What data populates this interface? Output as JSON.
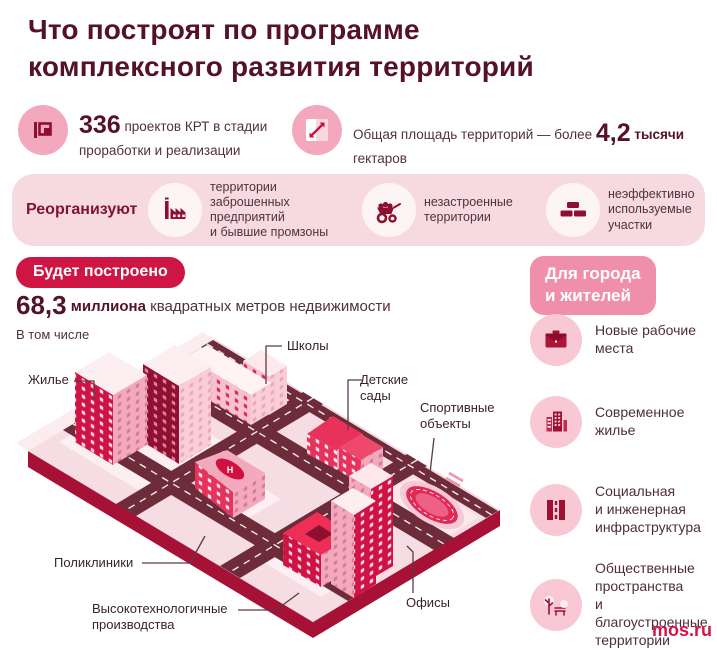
{
  "colors": {
    "dark_burgundy": "#551226",
    "accent_red": "#ce1543",
    "pink_badge": "#ef8fab",
    "band_bg": "#f7d9e1",
    "icon_dark": "#8e1030",
    "mosru_red": "#d31445"
  },
  "header": {
    "line1": "Что построят по программе",
    "line2": "комплексного развития территорий"
  },
  "stats": [
    {
      "icon": "area-plan-icon",
      "value": "336",
      "text": "проектов КРТ в стадии проработки и реализации"
    },
    {
      "icon": "expand-arrow-icon",
      "prefix": "Общая площадь территорий — более",
      "value": "4,2",
      "bold": "тысячи",
      "suffix": "гектаров"
    }
  ],
  "reorganize": {
    "label": "Реорганизуют",
    "items": [
      {
        "icon": "factory-icon",
        "text": "территории\nзаброшенных\nпредприятий\nи бывшие промзоны"
      },
      {
        "icon": "wheelbarrow-icon",
        "text": "незастроенные\nтерритории"
      },
      {
        "icon": "bricks-icon",
        "text": "неэффективно\nиспользуемые\nучастки"
      }
    ]
  },
  "built": {
    "badge": "Будет построено",
    "value": "68,3",
    "unit": "миллиона",
    "rest": "квадратных метров недвижимости",
    "including": "В том числе"
  },
  "map": {
    "labels": {
      "housing": "Жилье",
      "schools": "Школы",
      "kindergartens": "Детские\nсады",
      "sports": "Спортивные\nобъекты",
      "clinics": "Поликлиники",
      "hightech": "Высокотехнологичные\nпроизводства",
      "offices": "Офисы"
    }
  },
  "benefits": {
    "badge": "Для города\nи жителей",
    "items": [
      {
        "icon": "briefcase-icon",
        "text": "Новые рабочие\nместа"
      },
      {
        "icon": "city-buildings-icon",
        "text": "Современное\nжилье"
      },
      {
        "icon": "road-icon",
        "text": "Социальная\nи инженерная\nинфраструктура"
      },
      {
        "icon": "park-bench-icon",
        "text": "Общественные\nпространства\nи благоустроенные\nтерритории"
      }
    ]
  },
  "footer": {
    "source": "mos.ru"
  }
}
